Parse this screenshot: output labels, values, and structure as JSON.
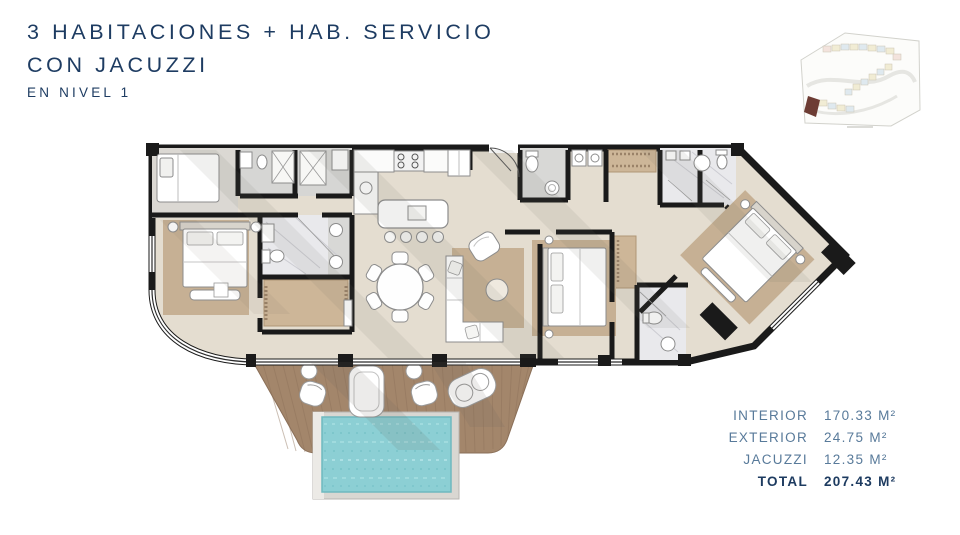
{
  "header": {
    "title_line1": "3 HABITACIONES + HAB. SERVICIO",
    "title_line2": "CON JACUZZI",
    "subtitle": "EN NIVEL 1"
  },
  "areas": {
    "rows": [
      {
        "label": "INTERIOR",
        "value": "170.33 M²"
      },
      {
        "label": "EXTERIOR",
        "value": "24.75 M²"
      },
      {
        "label": "JACUZZI",
        "value": "12.35 M²"
      },
      {
        "label": "TOTAL",
        "value": "207.43 M²"
      }
    ]
  },
  "colors": {
    "title_navy": "#1e3c62",
    "table_slate": "#587a9a",
    "wall_black": "#1a1a1a",
    "floor_beige": "#e4ddd0",
    "deck_wood": "#a3866b",
    "pool_turquoise": "#8ccfd4",
    "rug_tan": "#c6b094",
    "marble_gray": "#e9e9ec",
    "sitemap_highlight_maroon": "#6d3c34"
  }
}
